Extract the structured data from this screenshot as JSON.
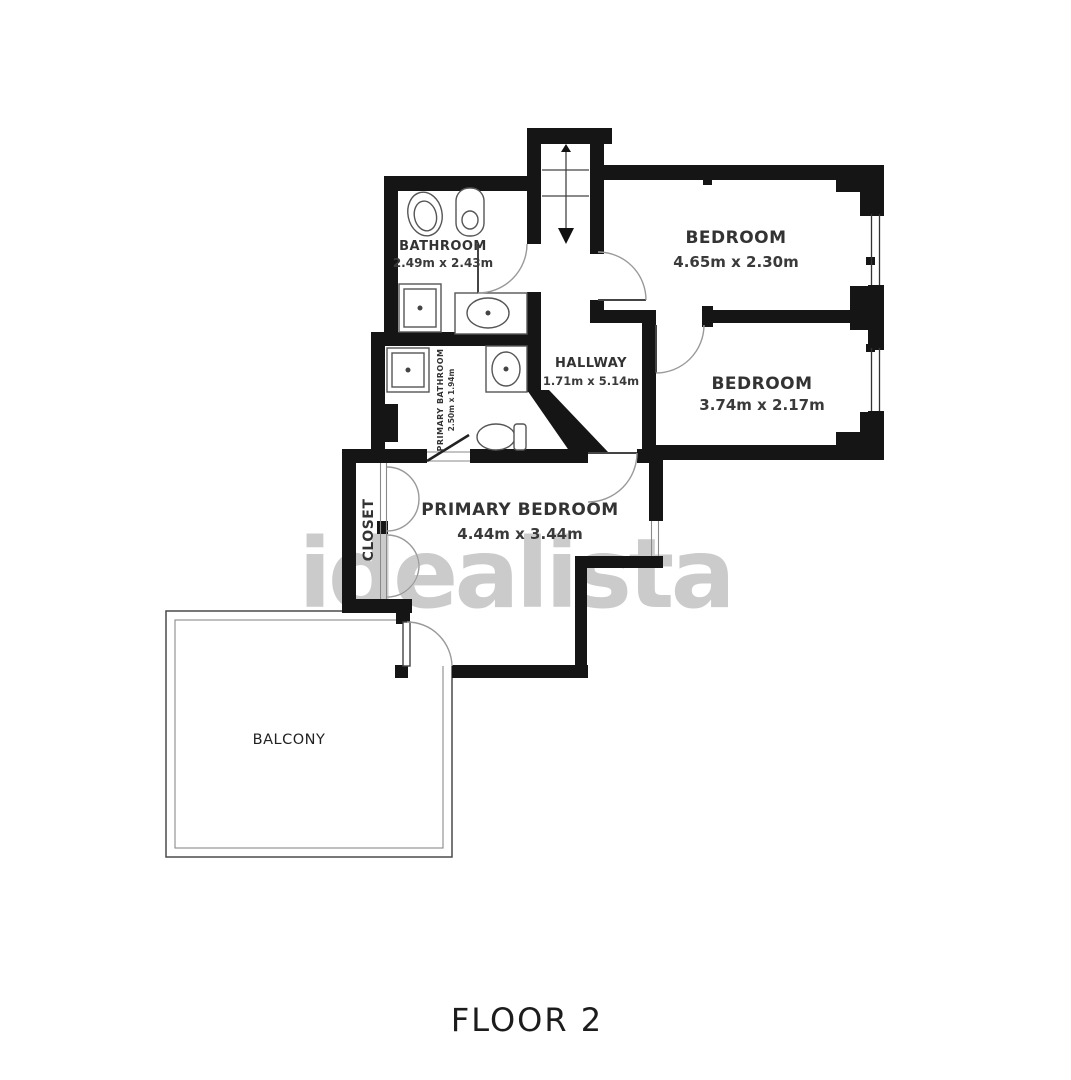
{
  "floorplan": {
    "title": "FLOOR 2",
    "watermark": "idealista",
    "rooms": {
      "bathroom": {
        "name": "BATHROOM",
        "dims": "2.49m x 2.43m"
      },
      "bedroom1": {
        "name": "BEDROOM",
        "dims": "4.65m x 2.30m"
      },
      "bedroom2": {
        "name": "BEDROOM",
        "dims": "3.74m x 2.17m"
      },
      "hallway": {
        "name": "HALLWAY",
        "dims": "1.71m x 5.14m"
      },
      "primary_bathroom": {
        "name": "PRIMARY BATHROOM",
        "dims": "2.50m x 1.94m"
      },
      "primary_bedroom": {
        "name": "PRIMARY BEDROOM",
        "dims": "4.44m x 3.44m"
      },
      "closet": {
        "name": "CLOSET"
      },
      "balcony": {
        "name": "BALCONY"
      }
    },
    "colors": {
      "wall": "#151515",
      "label": "#333333",
      "watermark": "#c8c8c8",
      "background": "#ffffff"
    }
  }
}
